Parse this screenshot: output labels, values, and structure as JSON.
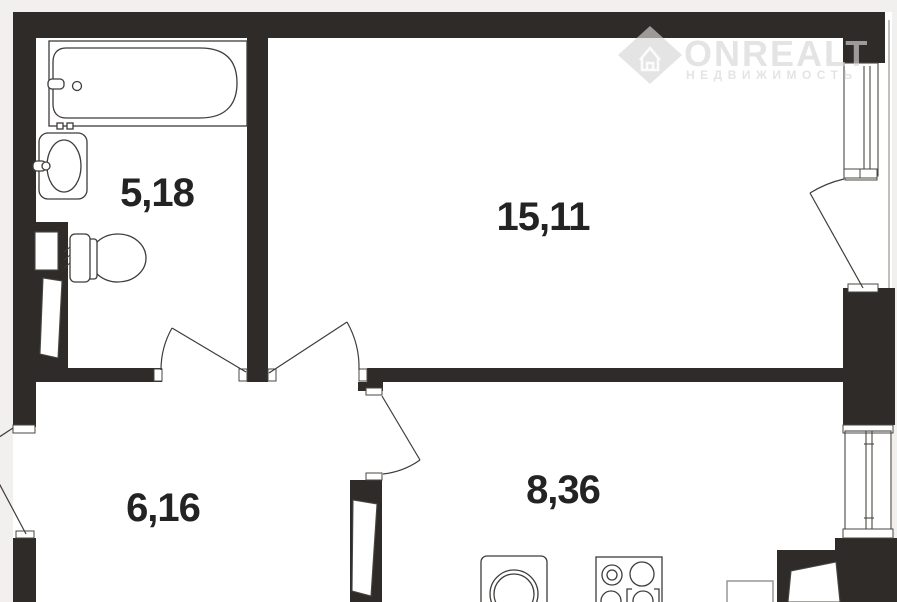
{
  "meta": {
    "type": "apartment-floor-plan"
  },
  "watermark": {
    "brand": "ONREALT",
    "tagline": "НЕДВИЖИМОСТЬ"
  },
  "rooms": [
    {
      "name": "bathroom",
      "area": "5,18"
    },
    {
      "name": "living-room",
      "area": "15,11"
    },
    {
      "name": "hallway",
      "area": "6,16"
    },
    {
      "name": "kitchen",
      "area": "8,36"
    }
  ],
  "colors": {
    "wall": "#2e2b28",
    "line": "#3f3c3a",
    "label": "#232323",
    "watermark": "rgba(214,214,214,0.66)",
    "margin": "#f2f0ee",
    "background": "#ffffff"
  }
}
